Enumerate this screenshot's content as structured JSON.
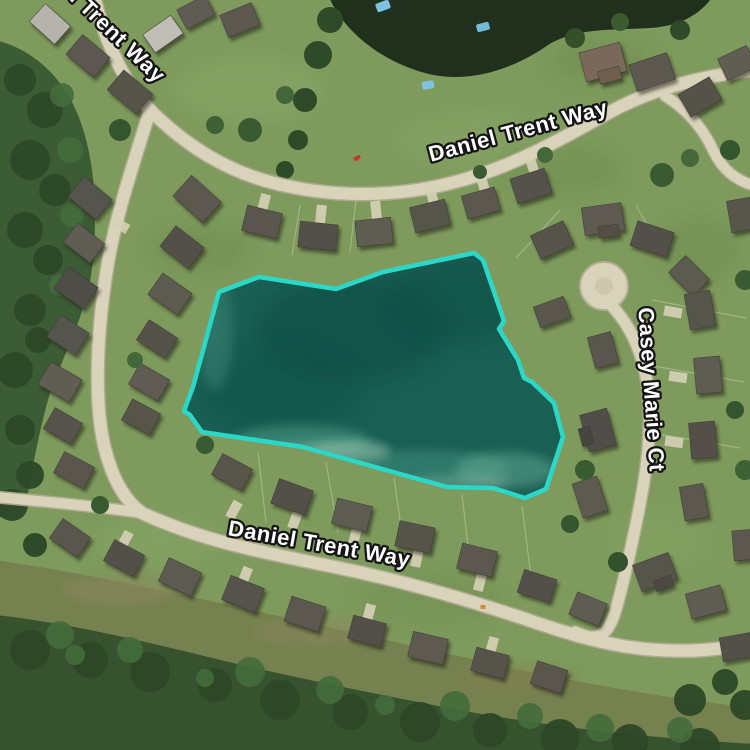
{
  "map": {
    "type": "satellite-imagery",
    "streets": {
      "top": {
        "label": "Daniel Trent Way"
      },
      "top_left": {
        "label": "Daniel Trent Way"
      },
      "bottom": {
        "label": "Daniel Trent Way"
      },
      "right": {
        "label": "Casey Marie Ct"
      }
    },
    "label_style": {
      "text_color": "#ffffff",
      "halo_color": "#141414"
    },
    "overlay": {
      "name": "pond-parcel-highlight",
      "outline_color": "#2BD8C8",
      "fill_color": "#1A5F54",
      "outline_width": "4.5",
      "polygon_points": "219,292 259,277 336,289 383,272 474,253 483,260 504,321 499,329 518,360 524,378 532,382 554,403 563,437 546,489 525,498 493,488 447,487 303,447 202,432 190,415 184,411 193,387"
    },
    "palette": {
      "grass": "#7E9B5D",
      "road": "#D9D3BB",
      "road_edge": "#B3AD94",
      "forest": "#3A5A33",
      "upper_pond_water": "#20301D",
      "roof_gray": "#57544C"
    }
  }
}
